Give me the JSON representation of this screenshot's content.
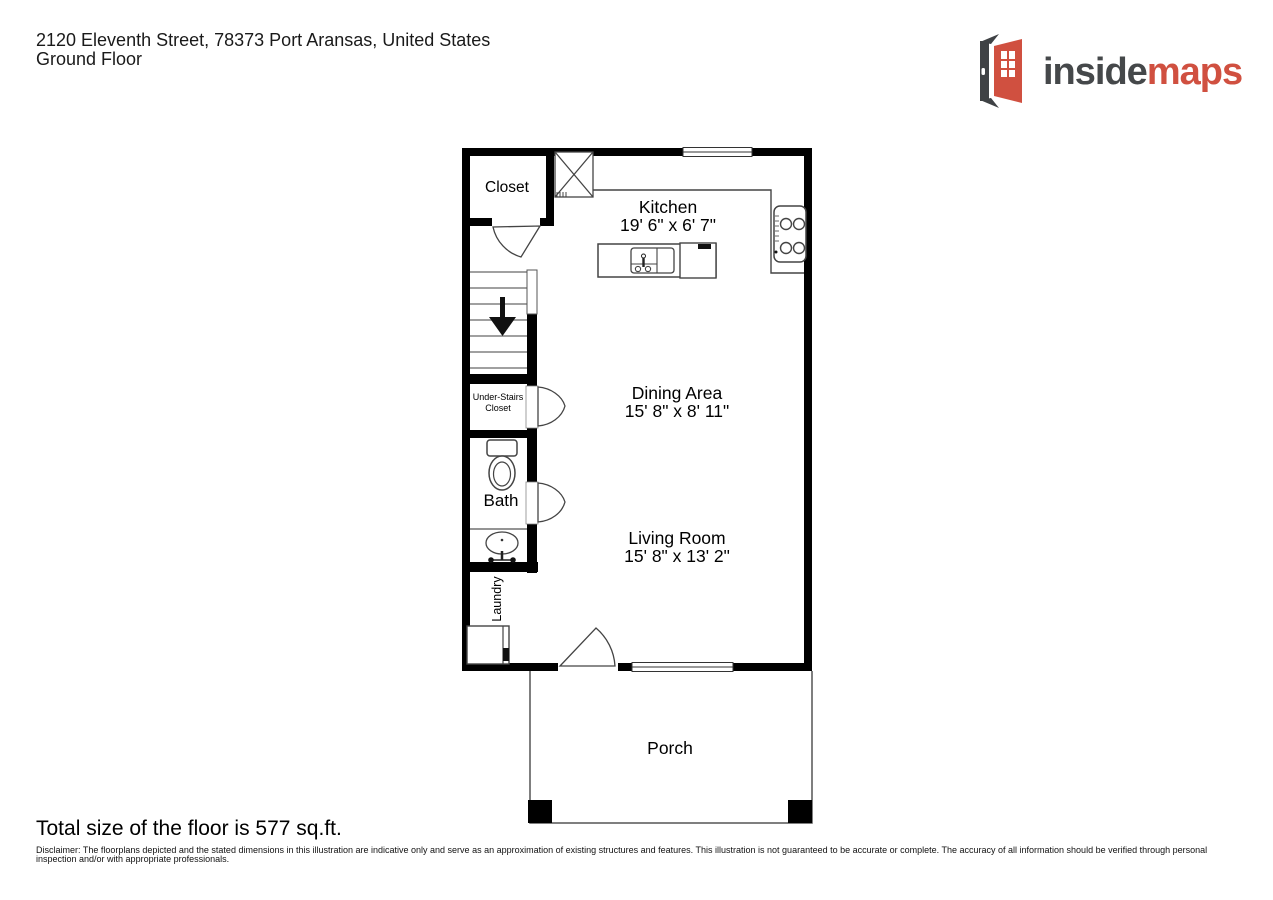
{
  "header": {
    "address": "2120 Eleventh Street, 78373 Port Aransas, United States",
    "floor": "Ground Floor"
  },
  "logo": {
    "text_primary": "inside",
    "text_accent": "maps",
    "color_primary": "#45484a",
    "color_accent": "#d05040",
    "icon": "open-door-icon"
  },
  "floorplan": {
    "closet": {
      "label": "Closet"
    },
    "kitchen": {
      "name": "Kitchen",
      "dims": "19' 6\" x 6' 7\""
    },
    "dining": {
      "name": "Dining Area",
      "dims": "15' 8\" x 8' 11\""
    },
    "living": {
      "name": "Living Room",
      "dims": "15' 8\" x 13' 2\""
    },
    "understairs": {
      "line1": "Under-Stairs",
      "line2": "Closet"
    },
    "bath": {
      "label": "Bath"
    },
    "laundry": {
      "label": "Laundry"
    },
    "porch": {
      "label": "Porch"
    },
    "icons": [
      "stairs-icon",
      "stairs-down-arrow-icon",
      "toilet-icon",
      "bathroom-sink-icon",
      "washer-icon",
      "water-heater-icon",
      "kitchen-island-icon",
      "kitchen-sink-icon",
      "dishwasher-icon",
      "stove-icon",
      "door-swing-icon",
      "window",
      "porch-post"
    ],
    "wall_color": "#000000",
    "line_color": "#444444"
  },
  "footer": {
    "total": "Total size of the floor is 577 sq.ft.",
    "disclaimer": "Disclaimer: The floorplans depicted and the stated dimensions in this illustration are indicative only and serve as an approximation of existing structures and features. This illustration is not guaranteed to be accurate or complete. The accuracy of all information should be verified through personal inspection and/or with appropriate professionals."
  }
}
